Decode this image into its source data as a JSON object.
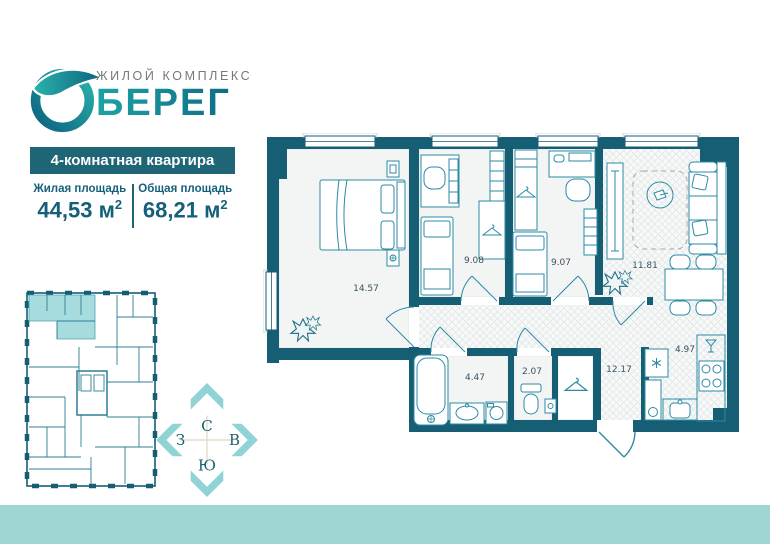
{
  "brand": {
    "complex_label": "ЖИЛОЙ КОМПЛЕКС",
    "name": "БЕРЕГ"
  },
  "apartment": {
    "type_label": "4-комнатная квартира",
    "living": {
      "label": "Жилая площадь",
      "value": "44,53 м",
      "sup": "2"
    },
    "total": {
      "label": "Общая площадь",
      "value": "68,21 м",
      "sup": "2"
    }
  },
  "compass": {
    "north": "С",
    "east": "В",
    "south": "Ю",
    "west": "З"
  },
  "plan": {
    "rooms": {
      "bedroom": "14.57",
      "kid1": "9.08",
      "kid2": "9.07",
      "living": "11.81",
      "hall": "12.17",
      "kitchen": "4.97",
      "bath": "4.47",
      "wc": "2.07"
    }
  },
  "colors": {
    "wall": "#155e74",
    "accent": "#1e6676",
    "teal-light": "#a7dcdf",
    "band": "#9fd6d3",
    "arrow": "#8fd3d7",
    "furn": "#2c8aa4",
    "text-dark": "#14607a",
    "label": "#3b5360",
    "gray-text": "#77787b"
  }
}
